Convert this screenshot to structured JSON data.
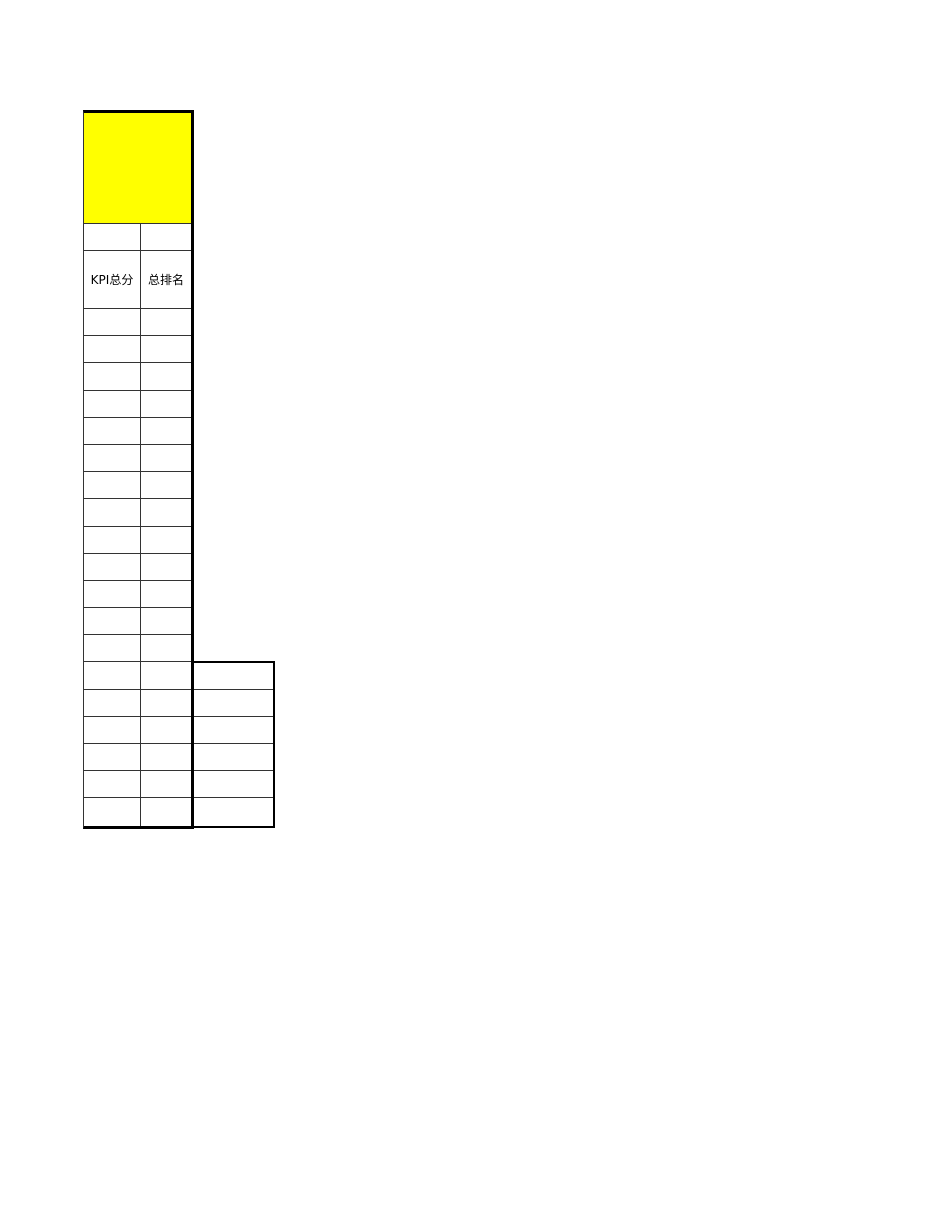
{
  "table": {
    "title_cell": {
      "text": "",
      "fill": "#ffff00"
    },
    "header_row": {
      "kpi_total_label": "KPI总分",
      "overall_rank_label": "总排名"
    },
    "body_row_count": 19,
    "extra_column": {
      "row_count": 6
    },
    "colors": {
      "highlight_fill": "#ffff00",
      "grid_line": "#333333",
      "thick_border": "#000000",
      "background": "#ffffff",
      "header_text": "#000000"
    }
  }
}
